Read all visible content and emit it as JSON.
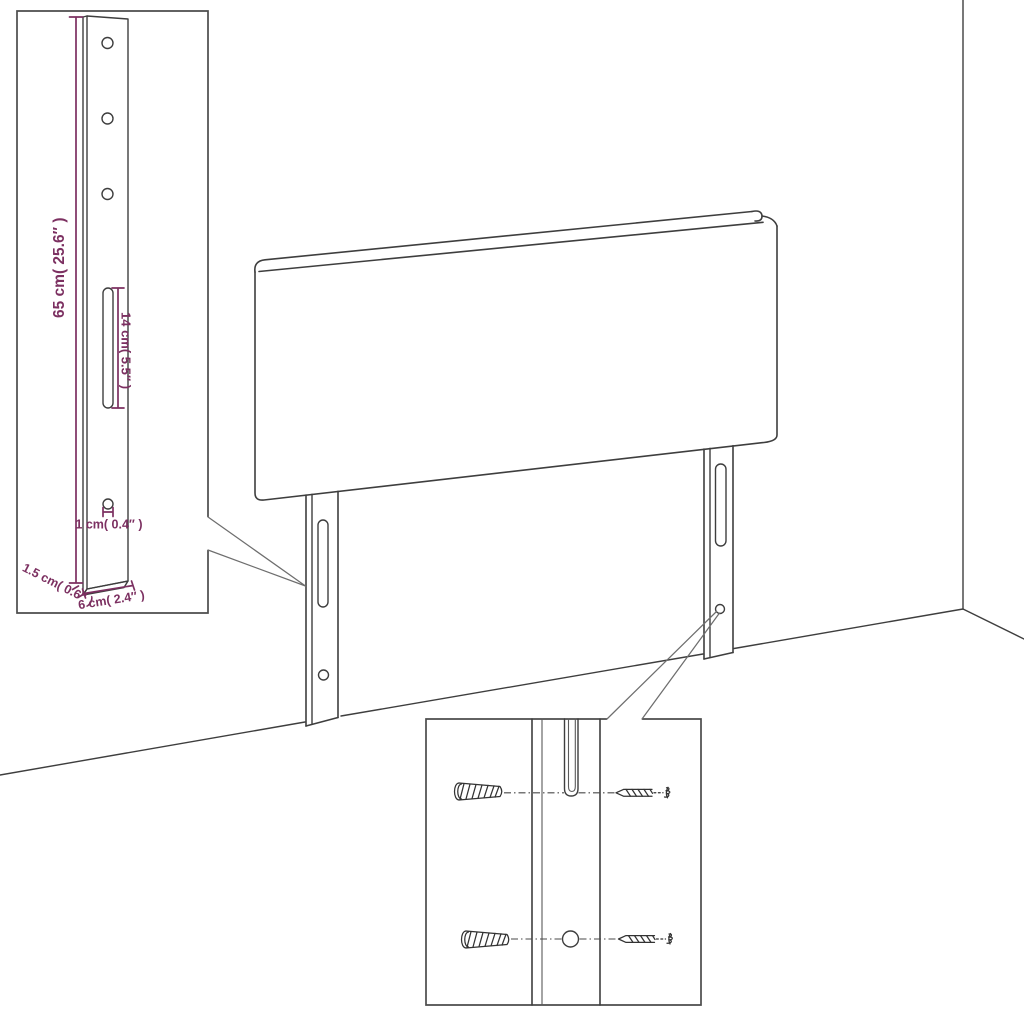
{
  "colors": {
    "dimension_accent": "#7c3061",
    "line_color": "#3e3e3e"
  },
  "dimensions": {
    "bracket_height": "65 cm( 25.6″ )",
    "slot_length": "14 cm( 5.5″ )",
    "hole_diameter": "1 cm( 0.4″ )",
    "bracket_thickness": "1.5 cm( 0.6″ )",
    "bracket_width": "6 cm( 2.4″ )"
  }
}
